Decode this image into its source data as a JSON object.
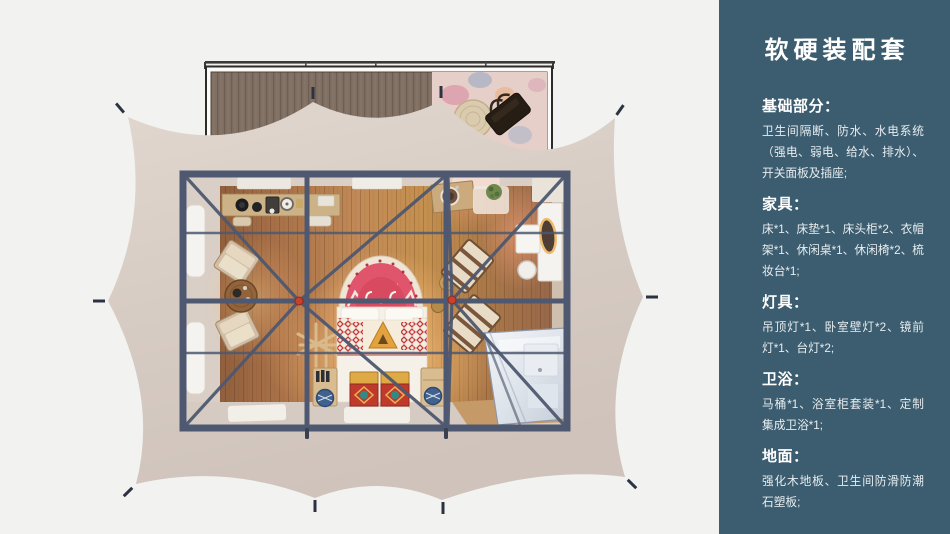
{
  "colors": {
    "page_bg": "#f2f2f1",
    "sidebar_bg": "#3c5d6f",
    "canvas": "#d7ccc4",
    "frame": "#4e5870",
    "accent_red": "#c8402e",
    "wood_floor": "#b07a4e",
    "deck_wood": "#7e6d60"
  },
  "sidebar": {
    "title": "软硬装配套",
    "sections": [
      {
        "heading": "基础部分：",
        "body": "卫生间隔断、防水、水电系统（强电、弱电、给水、排水）、开关面板及插座;"
      },
      {
        "heading": "家具：",
        "body": "床*1、床垫*1、床头柜*2、衣帽架*1、休闲桌*1、休闲椅*2、梳妆台*1;"
      },
      {
        "heading": "灯具：",
        "body": "吊顶灯*1、卧室壁灯*2、镜前灯*1、台灯*2;"
      },
      {
        "heading": "卫浴：",
        "body": "马桶*1、浴室柜套装*1、定制集成卫浴*1;"
      },
      {
        "heading": "地面：",
        "body": "强化木地板、卫生间防滑防潮石塑板;"
      }
    ]
  }
}
